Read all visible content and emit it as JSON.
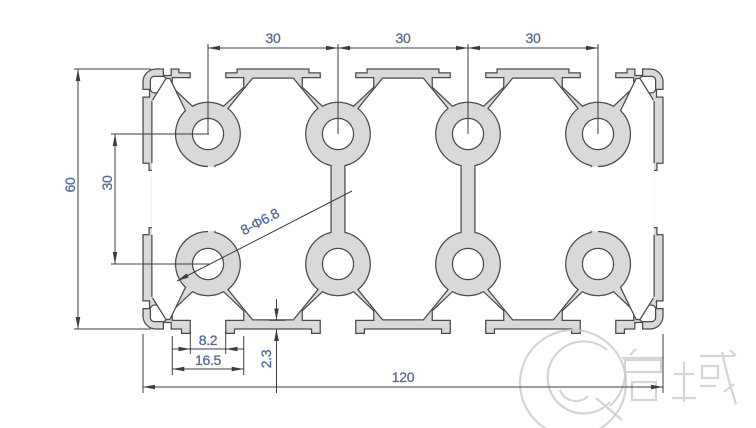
{
  "drawing": {
    "dims": {
      "top_spacing_1": "30",
      "top_spacing_2": "30",
      "top_spacing_3": "30",
      "overall_height": "60",
      "hole_row_spacing": "30",
      "holes_label": "8-Φ6.8",
      "slot_opening": "8.2",
      "slot_inner_width": "16.5",
      "lip_thickness": "2.3",
      "overall_width": "120"
    },
    "watermark": {
      "brand": "启域"
    }
  }
}
